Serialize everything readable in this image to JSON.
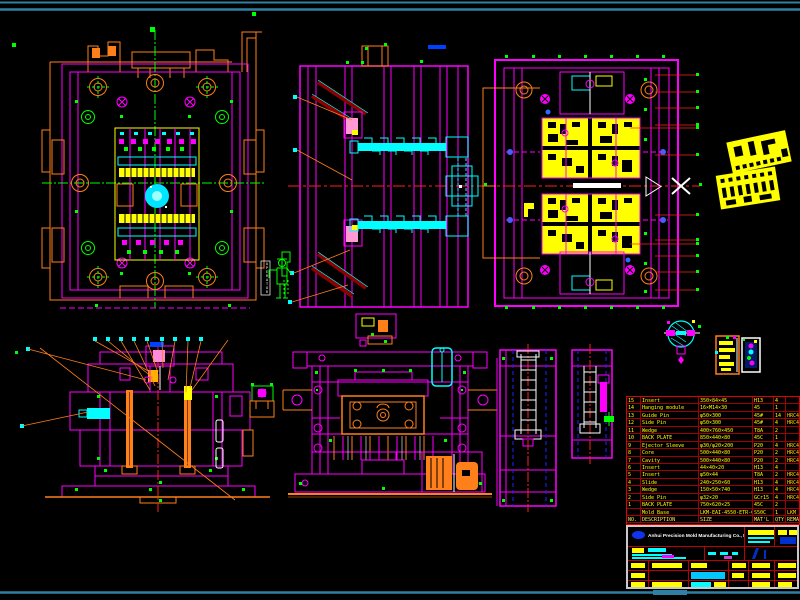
{
  "drawing": {
    "kind": "injection mold assembly CAD drawing",
    "background": "#000000",
    "sheet_border_color": "#2E81A5"
  },
  "colors": {
    "magenta": "#FF00FF",
    "orange": "#FF7F1A",
    "yellow": "#FFFF00",
    "cyan": "#00FFFF",
    "green": "#00FF00",
    "red": "#FF2020",
    "table_grid_red": "#A00000",
    "title_border_grey": "#C9C9C9",
    "logo_blue": "#1133EE"
  },
  "operator_marker": {
    "label": "OPERATOR"
  },
  "bom": {
    "headers": [
      "NO.",
      "DESCRIPTION",
      "SIZE",
      "MAT'L",
      "QTY.",
      "REMARK"
    ],
    "rows": [
      {
        "no": "15",
        "name": "Insert",
        "size": "350×84×45",
        "material": "H13",
        "qty": "4",
        "remark": ""
      },
      {
        "no": "14",
        "name": "Hanging module",
        "size": "16×M14×30",
        "material": "45",
        "qty": "1",
        "remark": ""
      },
      {
        "no": "13",
        "name": "Guide Pin",
        "size": "φ50×300",
        "material": "45#",
        "qty": "14",
        "remark": "HRC40-45"
      },
      {
        "no": "12",
        "name": "Side Pin",
        "size": "φ50×300",
        "material": "45#",
        "qty": "4",
        "remark": "HRC40-45"
      },
      {
        "no": "11",
        "name": "Wedge",
        "size": "400×760×450",
        "material": "T8A",
        "qty": "2",
        "remark": ""
      },
      {
        "no": "10",
        "name": "BACK PLATE",
        "size": "850×440×80",
        "material": "45C",
        "qty": "1",
        "remark": ""
      },
      {
        "no": "9",
        "name": "Ejector Sleeve",
        "size": "φ30/φ20×200",
        "material": "P20",
        "qty": "4",
        "remark": "HRC40-45"
      },
      {
        "no": "8",
        "name": "Core",
        "size": "500×440×80",
        "material": "P20",
        "qty": "2",
        "remark": "HRC40-45"
      },
      {
        "no": "7",
        "name": "Cavity",
        "size": "500×440×80",
        "material": "P20",
        "qty": "2",
        "remark": "HRC40-45"
      },
      {
        "no": "6",
        "name": "Insert",
        "size": "44×40×20",
        "material": "H13",
        "qty": "4",
        "remark": ""
      },
      {
        "no": "5",
        "name": "Insert",
        "size": "φ50×44",
        "material": "T8A",
        "qty": "2",
        "remark": "HRC40-45"
      },
      {
        "no": "4",
        "name": "Slide",
        "size": "240×250×60",
        "material": "H13",
        "qty": "4",
        "remark": "HRC40-45"
      },
      {
        "no": "3",
        "name": "Wedge",
        "size": "150×50×740",
        "material": "H13",
        "qty": "4",
        "remark": "HRC40-45"
      },
      {
        "no": "2",
        "name": "Side Pin",
        "size": "φ32×20",
        "material": "GCr15",
        "qty": "4",
        "remark": "HRC48-52"
      },
      {
        "no": "1",
        "name": "BACK PLATE",
        "size": "750×620×25",
        "material": "45C",
        "qty": "2",
        "remark": ""
      },
      {
        "no": "",
        "name": "Mold Base",
        "size": "LKM-EAI-4550-ETR-CI",
        "material": "S50C",
        "qty": "1",
        "remark": "LKM"
      }
    ]
  },
  "title_block": {
    "company": "Anhui Precision Mold Manufacturing Co., Ltd."
  }
}
